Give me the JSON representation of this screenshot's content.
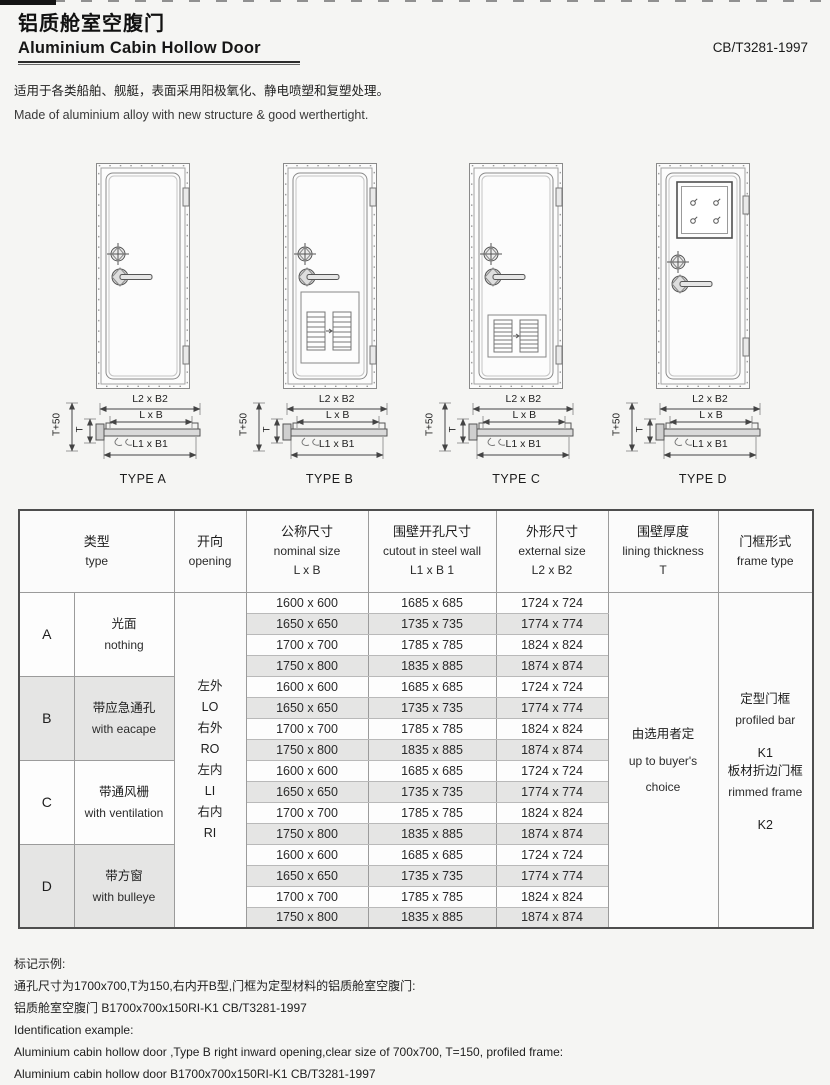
{
  "page": {
    "title_cn": "铝质舱室空腹门",
    "title_en": "Aluminium Cabin Hollow Door",
    "standard_code": "CB/T3281-1997",
    "intro_cn": "适用于各类船舶、舰艇，表面采用阳极氧化、静电喷塑和复塑处理。",
    "intro_en": "Made of aluminium alloy with new structure & good werthertight."
  },
  "diagrams": {
    "dim_labels": {
      "outer": "L2 x B2",
      "nominal": "L x B",
      "cutout": "L1 x B1",
      "t_plus": "T+50",
      "t": "T"
    },
    "types": [
      {
        "label": "TYPE A",
        "feature": "plain door"
      },
      {
        "label": "TYPE B",
        "feature": "door with escape louver panel"
      },
      {
        "label": "TYPE C",
        "feature": "door with ventilation louver"
      },
      {
        "label": "TYPE D",
        "feature": "door with square window"
      }
    ]
  },
  "table": {
    "headers": {
      "type_cn": "类型",
      "type_en": "type",
      "opening_cn": "开向",
      "opening_en": "opening",
      "nominal_cn": "公称尺寸",
      "nominal_en": "nominal size",
      "nominal_sym": "L x B",
      "cutout_cn": "围壁开孔尺寸",
      "cutout_en": "cutout in steel wall",
      "cutout_sym": "L1 x B 1",
      "external_cn": "外形尺寸",
      "external_en": "external  size",
      "external_sym": "L2 x B2",
      "lining_cn": "围壁厚度",
      "lining_en": "lining thickness",
      "lining_sym": "T",
      "frame_cn": "门框形式",
      "frame_en": "frame type"
    },
    "types": [
      {
        "letter": "A",
        "desc_cn": "光面",
        "desc_en": "nothing"
      },
      {
        "letter": "B",
        "desc_cn": "带应急通孔",
        "desc_en": "with eacape"
      },
      {
        "letter": "C",
        "desc_cn": "带通风栅",
        "desc_en": "with ventilation"
      },
      {
        "letter": "D",
        "desc_cn": "带方窗",
        "desc_en": "with bulleye"
      }
    ],
    "openings": [
      {
        "cn": "左外",
        "en": "LO"
      },
      {
        "cn": "右外",
        "en": "RO"
      },
      {
        "cn": "左内",
        "en": "LI"
      },
      {
        "cn": "右内",
        "en": "RI"
      }
    ],
    "sizes": [
      {
        "nominal": "1600 x 600",
        "cutout": "1685 x 685",
        "external": "1724 x 724"
      },
      {
        "nominal": "1650 x 650",
        "cutout": "1735 x 735",
        "external": "1774 x 774"
      },
      {
        "nominal": "1700 x 700",
        "cutout": "1785 x 785",
        "external": "1824 x 824"
      },
      {
        "nominal": "1750 x 800",
        "cutout": "1835 x 885",
        "external": "1874 x 874"
      }
    ],
    "lining": {
      "cn": "由选用者定",
      "en1": "up to buyer's",
      "en2": "choice"
    },
    "frames": [
      {
        "cn": "定型门框",
        "en": "profiled bar",
        "code": "K1"
      },
      {
        "cn": "板材折边门框",
        "en": "rimmed frame",
        "code": "K2"
      }
    ]
  },
  "footer": {
    "example_title_cn": "标记示例:",
    "line1_cn": "通孔尺寸为1700x700,T为150,右内开B型,门框为定型材料的铝质舱室空腹门:",
    "line2_cn": "铝质舱室空腹门 B1700x700x150RI-K1 CB/T3281-1997",
    "example_title_en": "Identification example:",
    "line1_en": "Aluminium cabin hollow door ,Type B right inward opening,clear size of 700x700, T=150, profiled frame:",
    "line2_en": "Aluminium cabin hollow door B1700x700x150RI-K1 CB/T3281-1997"
  }
}
